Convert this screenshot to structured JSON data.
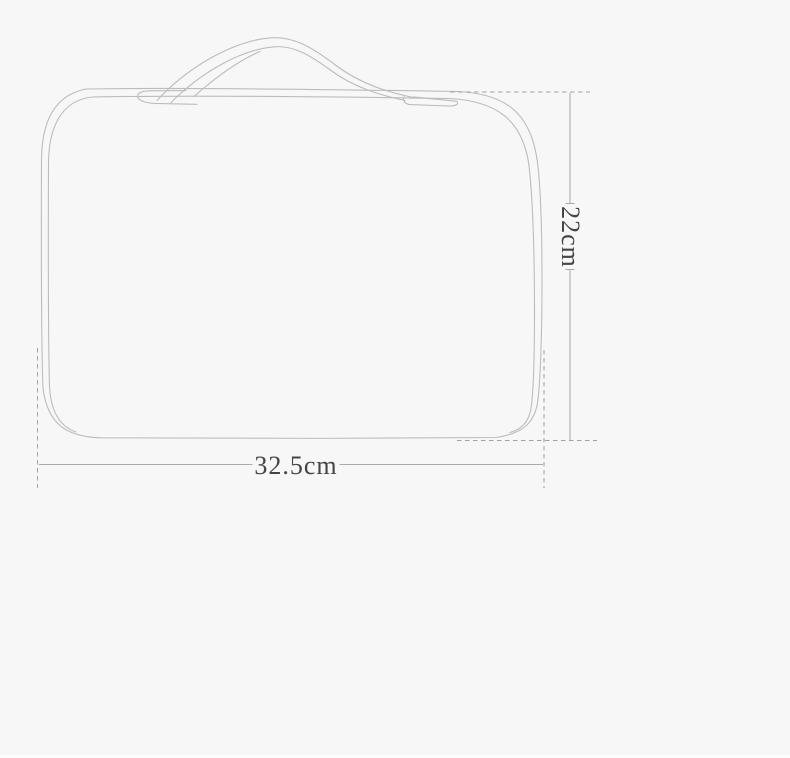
{
  "diagram": {
    "kind": "product-dimension-line-drawing",
    "subject_icon": "bag-outline-icon",
    "width_label": "32.5cm",
    "height_label": "22cm",
    "width_cm": 32.5,
    "height_cm": 22,
    "unit": "cm",
    "colors": {
      "background": "#f7f7f7",
      "outline": "#bcbcbe",
      "dimension_line": "#a9aaac",
      "dash_line": "#9fa0a3",
      "label_text": "#454545",
      "bottom_edge": "#fcfcfc"
    }
  }
}
